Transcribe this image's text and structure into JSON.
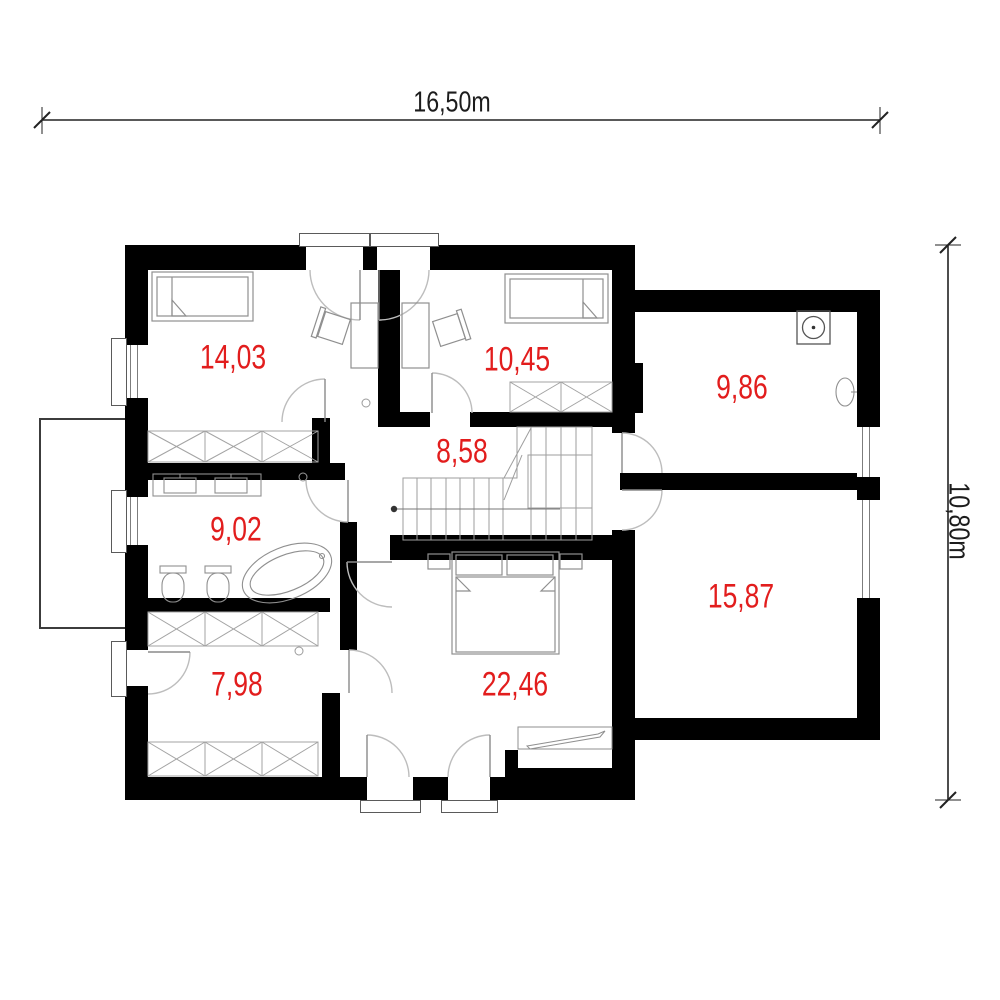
{
  "drawing": {
    "kind": "floor-plan",
    "wall_color": "#000000",
    "label_color": "#e21d1d"
  },
  "dimensions": {
    "width": "16,50m",
    "height": "10,80m"
  },
  "rooms": [
    {
      "area": "14,03"
    },
    {
      "area": "10,45"
    },
    {
      "area": "9,86"
    },
    {
      "area": "8,58"
    },
    {
      "area": "9,02"
    },
    {
      "area": "15,87"
    },
    {
      "area": "7,98"
    },
    {
      "area": "22,46"
    }
  ]
}
